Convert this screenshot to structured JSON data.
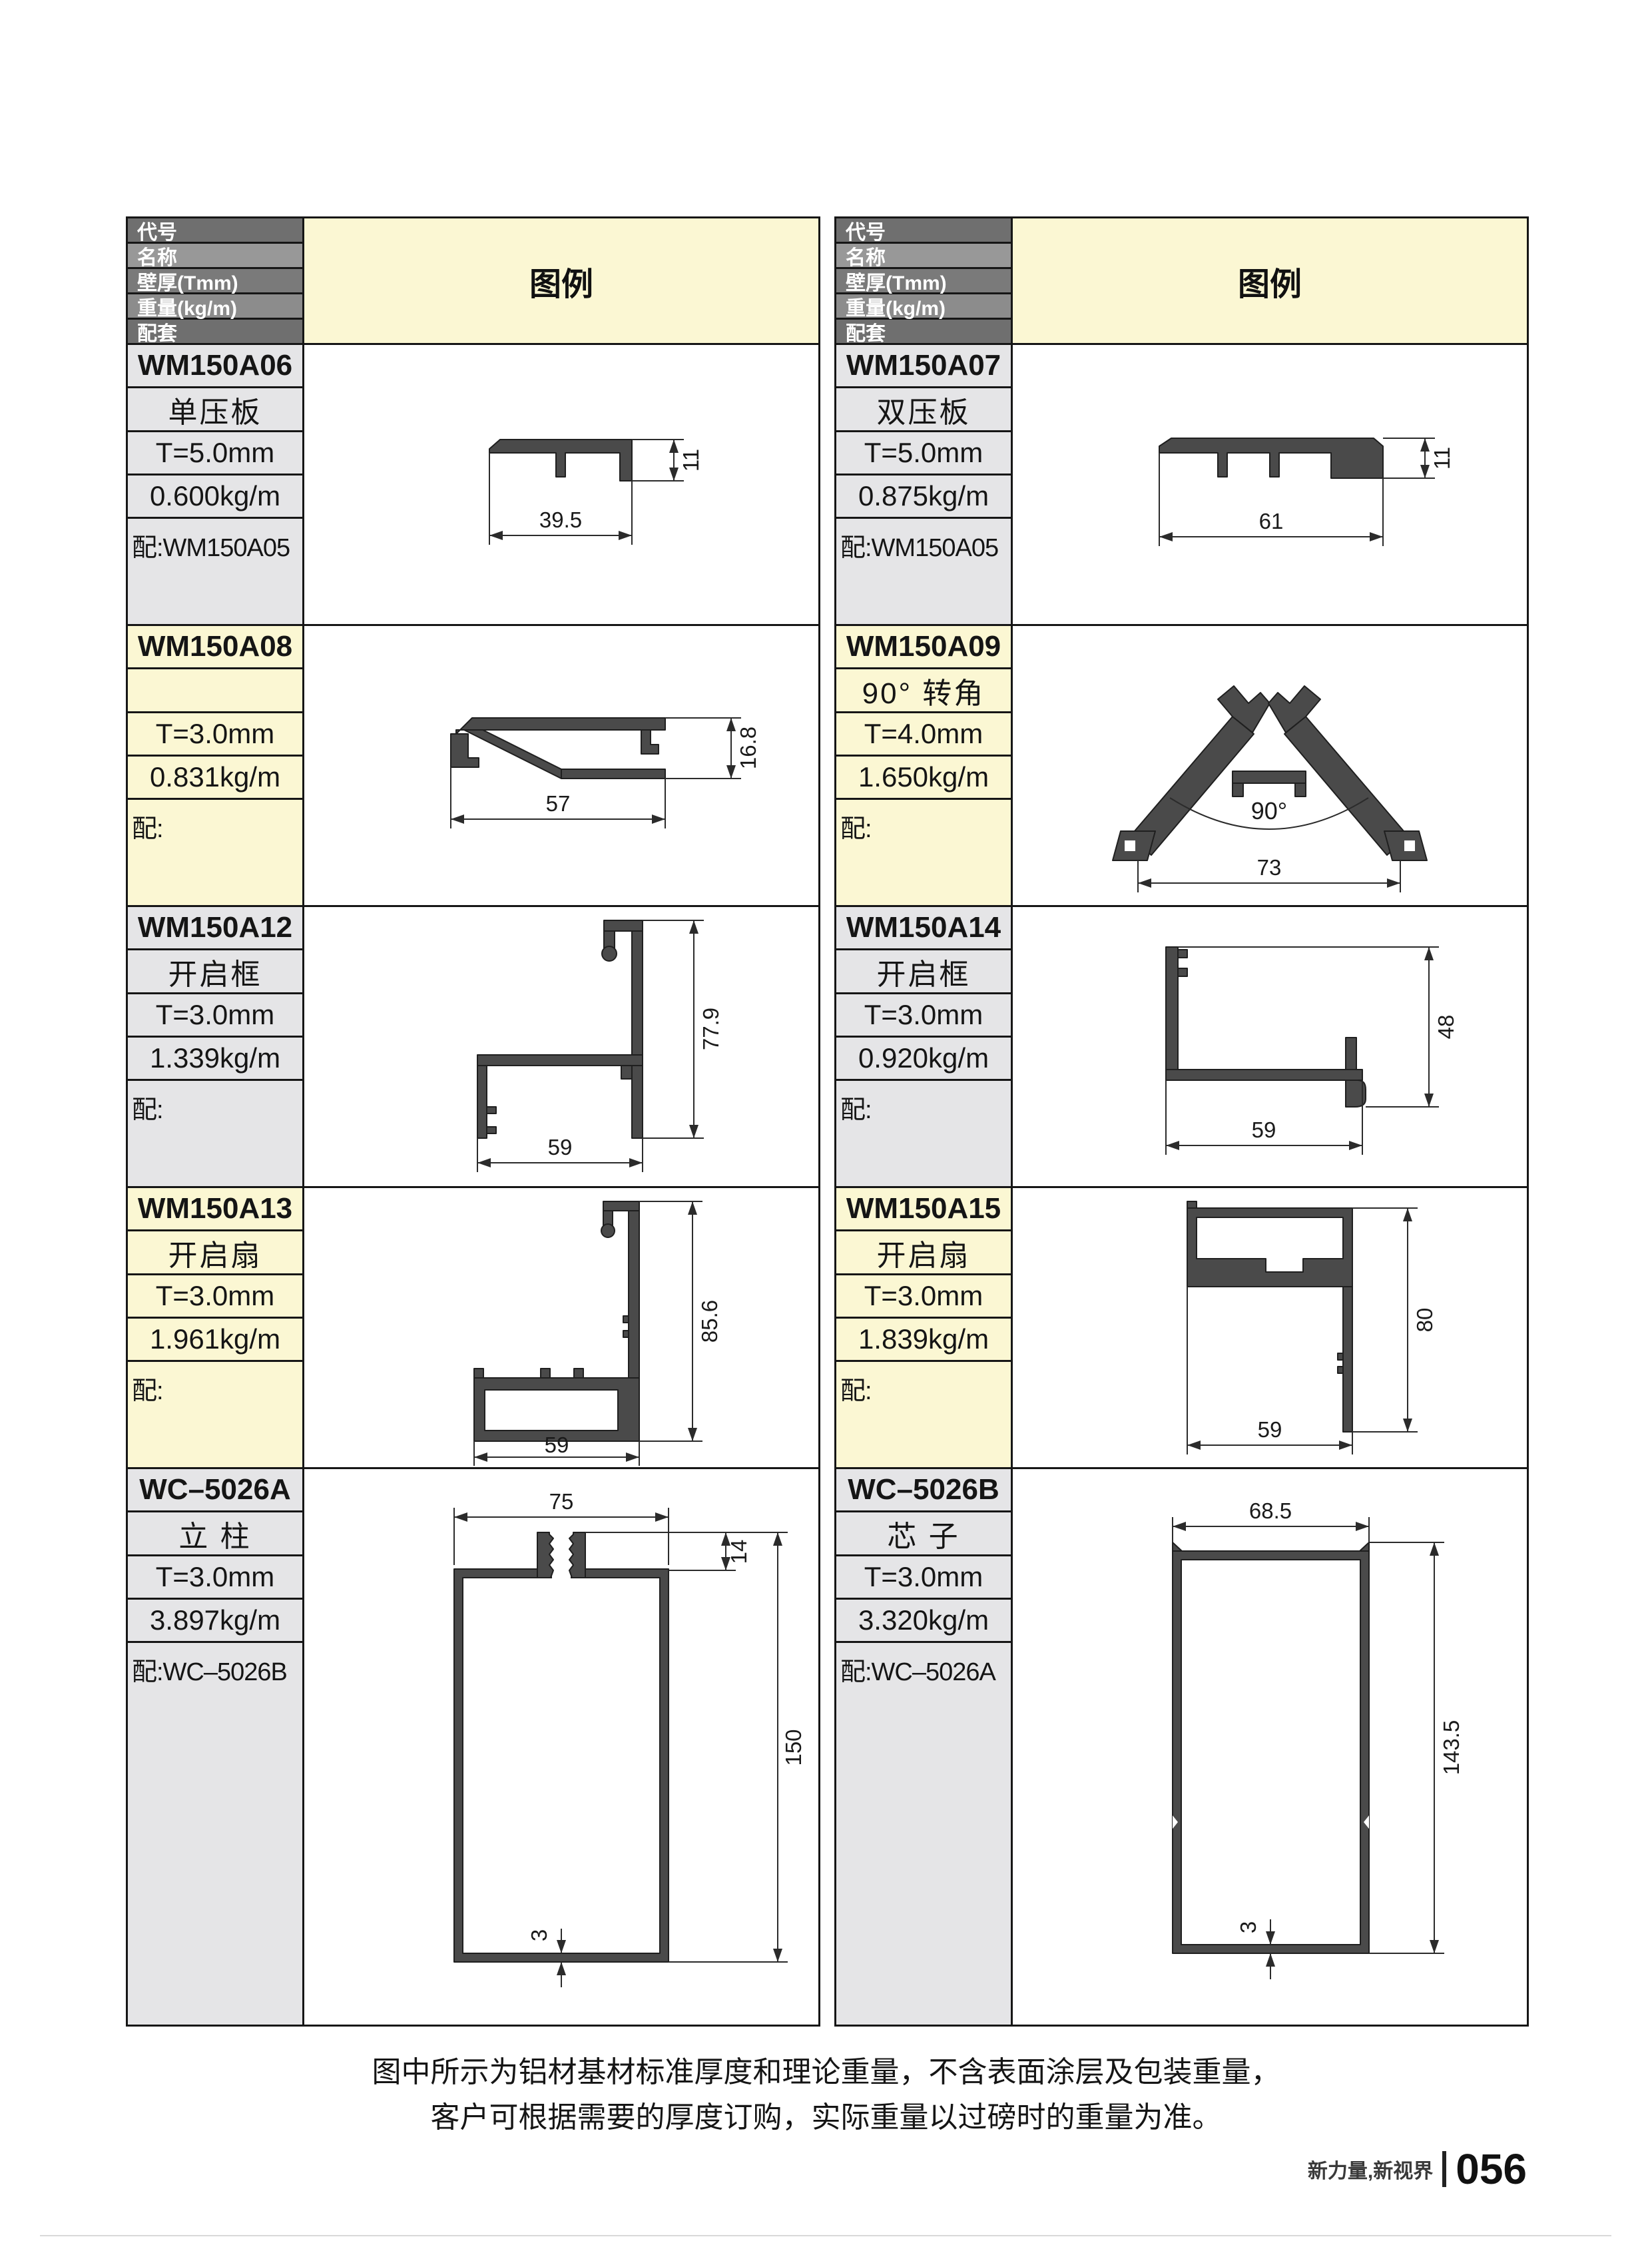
{
  "legend_label": "图例",
  "header_labels": [
    "代号",
    "名称",
    "壁厚(Tmm)",
    "重量(kg/m)",
    "配套"
  ],
  "colors": {
    "header_gray": "#6F6F6F",
    "cell_gray": "#E5E5E7",
    "cell_yellow": "#FBF7D3",
    "profile_fill": "#4A4A4A"
  },
  "tables": [
    {
      "blocks": [
        {
          "code": "WM150A06",
          "name": "单压板",
          "thickness": "T=5.0mm",
          "weight": "0.600kg/m",
          "match": "配:WM150A05"
        },
        {
          "code": "WM150A08",
          "name": "",
          "thickness": "T=3.0mm",
          "weight": "0.831kg/m",
          "match": "配:"
        },
        {
          "code": "WM150A12",
          "name": "开启框",
          "thickness": "T=3.0mm",
          "weight": "1.339kg/m",
          "match": "配:"
        },
        {
          "code": "WM150A13",
          "name": "开启扇",
          "thickness": "T=3.0mm",
          "weight": "1.961kg/m",
          "match": "配:"
        },
        {
          "code": "WC–5026A",
          "name": "立 柱",
          "thickness": "T=3.0mm",
          "weight": "3.897kg/m",
          "match": "配:WC–5026B"
        }
      ]
    },
    {
      "blocks": [
        {
          "code": "WM150A07",
          "name": "双压板",
          "thickness": "T=5.0mm",
          "weight": "0.875kg/m",
          "match": "配:WM150A05"
        },
        {
          "code": "WM150A09",
          "name": "90° 转角",
          "thickness": "T=4.0mm",
          "weight": "1.650kg/m",
          "match": "配:"
        },
        {
          "code": "WM150A14",
          "name": "开启框",
          "thickness": "T=3.0mm",
          "weight": "0.920kg/m",
          "match": "配:"
        },
        {
          "code": "WM150A15",
          "name": "开启扇",
          "thickness": "T=3.0mm",
          "weight": "1.839kg/m",
          "match": "配:"
        },
        {
          "code": "WC–5026B",
          "name": "芯 子",
          "thickness": "T=3.0mm",
          "weight": "3.320kg/m",
          "match": "配:WC–5026A"
        }
      ]
    }
  ],
  "drawings": {
    "wm150a06": {
      "w": "39.5",
      "h": "11"
    },
    "wm150a08": {
      "w": "57",
      "h": "16.8"
    },
    "wm150a12": {
      "w": "59",
      "h": "77.9"
    },
    "wm150a13": {
      "w": "59",
      "h": "85.6"
    },
    "wc5026a": {
      "w": "75",
      "h": "150",
      "top": "14",
      "wall": "3"
    },
    "wm150a07": {
      "w": "61",
      "h": "11"
    },
    "wm150a09": {
      "w": "73",
      "angle": "90°"
    },
    "wm150a14": {
      "w": "59",
      "h": "48"
    },
    "wm150a15": {
      "w": "59",
      "h": "80"
    },
    "wc5026b": {
      "w": "68.5",
      "h": "143.5",
      "wall": "3"
    }
  },
  "notes": [
    "图中所示为铝材基材标准厚度和理论重量，不含表面涂层及包装重量，",
    "客户可根据需要的厚度订购，实际重量以过磅时的重量为准。"
  ],
  "footer": {
    "slogan": "新力量,新视界",
    "page_number": "056"
  }
}
